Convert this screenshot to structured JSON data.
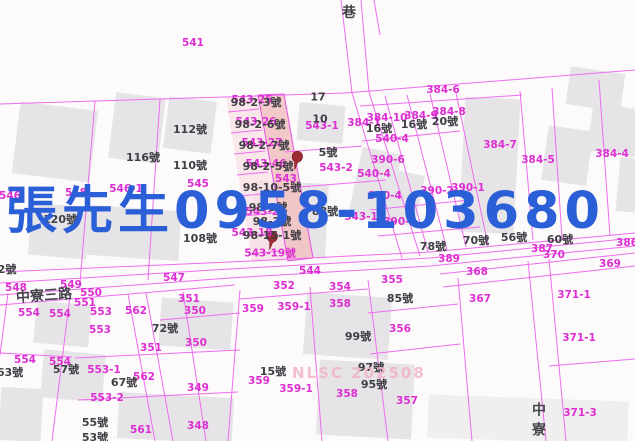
{
  "map": {
    "overlay": {
      "text": "張先生0958-103680",
      "color": "#2a5fd7"
    },
    "watermark": {
      "text": "NLSC 202508"
    },
    "road_labels": [
      {
        "text": "巷",
        "x": 349,
        "y": 12
      },
      {
        "text": "中寮三路",
        "x": 44,
        "y": 295,
        "r": -4
      },
      {
        "text": "中寮",
        "x": 538,
        "y": 422,
        "v": true
      }
    ],
    "parcel_labels": [
      {
        "text": "541",
        "x": 193,
        "y": 43
      },
      {
        "text": "546",
        "x": 10,
        "y": 196
      },
      {
        "text": "548",
        "x": 76,
        "y": 193
      },
      {
        "text": "546-1",
        "x": 126,
        "y": 189
      },
      {
        "text": "545",
        "x": 198,
        "y": 184
      },
      {
        "text": "543",
        "x": 286,
        "y": 179
      },
      {
        "text": "543-1",
        "x": 322,
        "y": 126
      },
      {
        "text": "543-2",
        "x": 336,
        "y": 168
      },
      {
        "text": "543-1",
        "x": 361,
        "y": 217
      },
      {
        "text": "540-4",
        "x": 392,
        "y": 139
      },
      {
        "text": "540-4",
        "x": 374,
        "y": 174
      },
      {
        "text": "390-6",
        "x": 388,
        "y": 160
      },
      {
        "text": "390-4",
        "x": 385,
        "y": 196
      },
      {
        "text": "390-3",
        "x": 400,
        "y": 222
      },
      {
        "text": "390-2",
        "x": 437,
        "y": 191
      },
      {
        "text": "390-1",
        "x": 468,
        "y": 188
      },
      {
        "text": "384-6",
        "x": 443,
        "y": 90
      },
      {
        "text": "384-1",
        "x": 364,
        "y": 123
      },
      {
        "text": "384-10",
        "x": 387,
        "y": 118
      },
      {
        "text": "384-9",
        "x": 421,
        "y": 116
      },
      {
        "text": "384-8",
        "x": 449,
        "y": 112
      },
      {
        "text": "384-7",
        "x": 500,
        "y": 145
      },
      {
        "text": "384-5",
        "x": 538,
        "y": 160
      },
      {
        "text": "384-4",
        "x": 612,
        "y": 154
      },
      {
        "text": "547",
        "x": 174,
        "y": 278
      },
      {
        "text": "548",
        "x": 16,
        "y": 288
      },
      {
        "text": "549",
        "x": 71,
        "y": 285
      },
      {
        "text": "550",
        "x": 91,
        "y": 293
      },
      {
        "text": "551",
        "x": 85,
        "y": 303
      },
      {
        "text": "544",
        "x": 310,
        "y": 271
      },
      {
        "text": "562",
        "x": 136,
        "y": 311
      },
      {
        "text": "562",
        "x": 144,
        "y": 377
      },
      {
        "text": "561",
        "x": 141,
        "y": 430
      },
      {
        "text": "351",
        "x": 189,
        "y": 299
      },
      {
        "text": "350",
        "x": 195,
        "y": 311
      },
      {
        "text": "351",
        "x": 151,
        "y": 348
      },
      {
        "text": "350",
        "x": 196,
        "y": 343
      },
      {
        "text": "349",
        "x": 198,
        "y": 388
      },
      {
        "text": "348",
        "x": 198,
        "y": 426
      },
      {
        "text": "553",
        "x": 101,
        "y": 312
      },
      {
        "text": "553",
        "x": 100,
        "y": 330
      },
      {
        "text": "554",
        "x": 29,
        "y": 313
      },
      {
        "text": "554",
        "x": 60,
        "y": 314
      },
      {
        "text": "554",
        "x": 25,
        "y": 360
      },
      {
        "text": "554",
        "x": 60,
        "y": 362
      },
      {
        "text": "553-1",
        "x": 104,
        "y": 370
      },
      {
        "text": "553-2",
        "x": 107,
        "y": 398
      },
      {
        "text": "352",
        "x": 284,
        "y": 286
      },
      {
        "text": "354",
        "x": 340,
        "y": 287
      },
      {
        "text": "355",
        "x": 392,
        "y": 280
      },
      {
        "text": "358",
        "x": 340,
        "y": 304
      },
      {
        "text": "359",
        "x": 253,
        "y": 309
      },
      {
        "text": "359-1",
        "x": 294,
        "y": 307
      },
      {
        "text": "356",
        "x": 400,
        "y": 329
      },
      {
        "text": "359",
        "x": 259,
        "y": 381
      },
      {
        "text": "359-1",
        "x": 296,
        "y": 389
      },
      {
        "text": "358",
        "x": 347,
        "y": 394
      },
      {
        "text": "357",
        "x": 407,
        "y": 401
      },
      {
        "text": "367",
        "x": 480,
        "y": 299
      },
      {
        "text": "368",
        "x": 477,
        "y": 272
      },
      {
        "text": "369",
        "x": 610,
        "y": 264
      },
      {
        "text": "370",
        "x": 554,
        "y": 255
      },
      {
        "text": "387",
        "x": 542,
        "y": 249
      },
      {
        "text": "389",
        "x": 449,
        "y": 259
      },
      {
        "text": "386",
        "x": 627,
        "y": 243
      },
      {
        "text": "371-1",
        "x": 574,
        "y": 295
      },
      {
        "text": "371-1",
        "x": 579,
        "y": 338
      },
      {
        "text": "371-3",
        "x": 580,
        "y": 413
      },
      {
        "text": "543-25",
        "x": 252,
        "y": 100
      },
      {
        "text": "543-26",
        "x": 256,
        "y": 122
      },
      {
        "text": "543-27",
        "x": 262,
        "y": 143
      },
      {
        "text": "543-46",
        "x": 266,
        "y": 164
      },
      {
        "text": "543-22",
        "x": 266,
        "y": 212
      },
      {
        "text": "543-18",
        "x": 252,
        "y": 233
      },
      {
        "text": "543-19號",
        "x": 270,
        "y": 253
      }
    ],
    "house_labels": [
      {
        "text": "112號",
        "x": 190,
        "y": 129
      },
      {
        "text": "116號",
        "x": 143,
        "y": 157
      },
      {
        "text": "110號",
        "x": 190,
        "y": 165
      },
      {
        "text": "120號",
        "x": 60,
        "y": 219
      },
      {
        "text": "108號",
        "x": 200,
        "y": 238
      },
      {
        "text": "2號",
        "x": 7,
        "y": 269
      },
      {
        "text": "5號",
        "x": 328,
        "y": 152
      },
      {
        "text": "16號",
        "x": 379,
        "y": 128
      },
      {
        "text": "16號",
        "x": 414,
        "y": 124
      },
      {
        "text": "20號",
        "x": 445,
        "y": 121
      },
      {
        "text": "88號",
        "x": 325,
        "y": 211
      },
      {
        "text": "78號",
        "x": 433,
        "y": 246
      },
      {
        "text": "70號",
        "x": 476,
        "y": 240
      },
      {
        "text": "56號",
        "x": 514,
        "y": 237
      },
      {
        "text": "60號",
        "x": 560,
        "y": 239
      },
      {
        "text": "72號",
        "x": 165,
        "y": 328
      },
      {
        "text": "57號",
        "x": 66,
        "y": 369
      },
      {
        "text": "63號",
        "x": 10,
        "y": 372
      },
      {
        "text": "67號",
        "x": 124,
        "y": 382
      },
      {
        "text": "55號",
        "x": 95,
        "y": 422
      },
      {
        "text": "53號",
        "x": 95,
        "y": 437
      },
      {
        "text": "15號",
        "x": 273,
        "y": 371
      },
      {
        "text": "99號",
        "x": 358,
        "y": 336
      },
      {
        "text": "97號",
        "x": 371,
        "y": 367
      },
      {
        "text": "95號",
        "x": 374,
        "y": 384
      },
      {
        "text": "85號",
        "x": 400,
        "y": 298
      },
      {
        "text": "98-2-3號",
        "x": 256,
        "y": 102
      },
      {
        "text": "17",
        "x": 318,
        "y": 97
      },
      {
        "text": "98-2-6號",
        "x": 260,
        "y": 124
      },
      {
        "text": "10",
        "x": 320,
        "y": 119
      },
      {
        "text": "98-2-7號",
        "x": 264,
        "y": 145
      },
      {
        "text": "98-2-5號",
        "x": 268,
        "y": 166
      },
      {
        "text": "98-10-5號",
        "x": 272,
        "y": 187
      },
      {
        "text": "98-3號",
        "x": 268,
        "y": 207
      },
      {
        "text": "98-2號",
        "x": 272,
        "y": 221
      },
      {
        "text": "98-15-1號",
        "x": 272,
        "y": 235
      }
    ],
    "pins": [
      {
        "x": 296,
        "y": 163
      },
      {
        "x": 271,
        "y": 243
      }
    ]
  }
}
